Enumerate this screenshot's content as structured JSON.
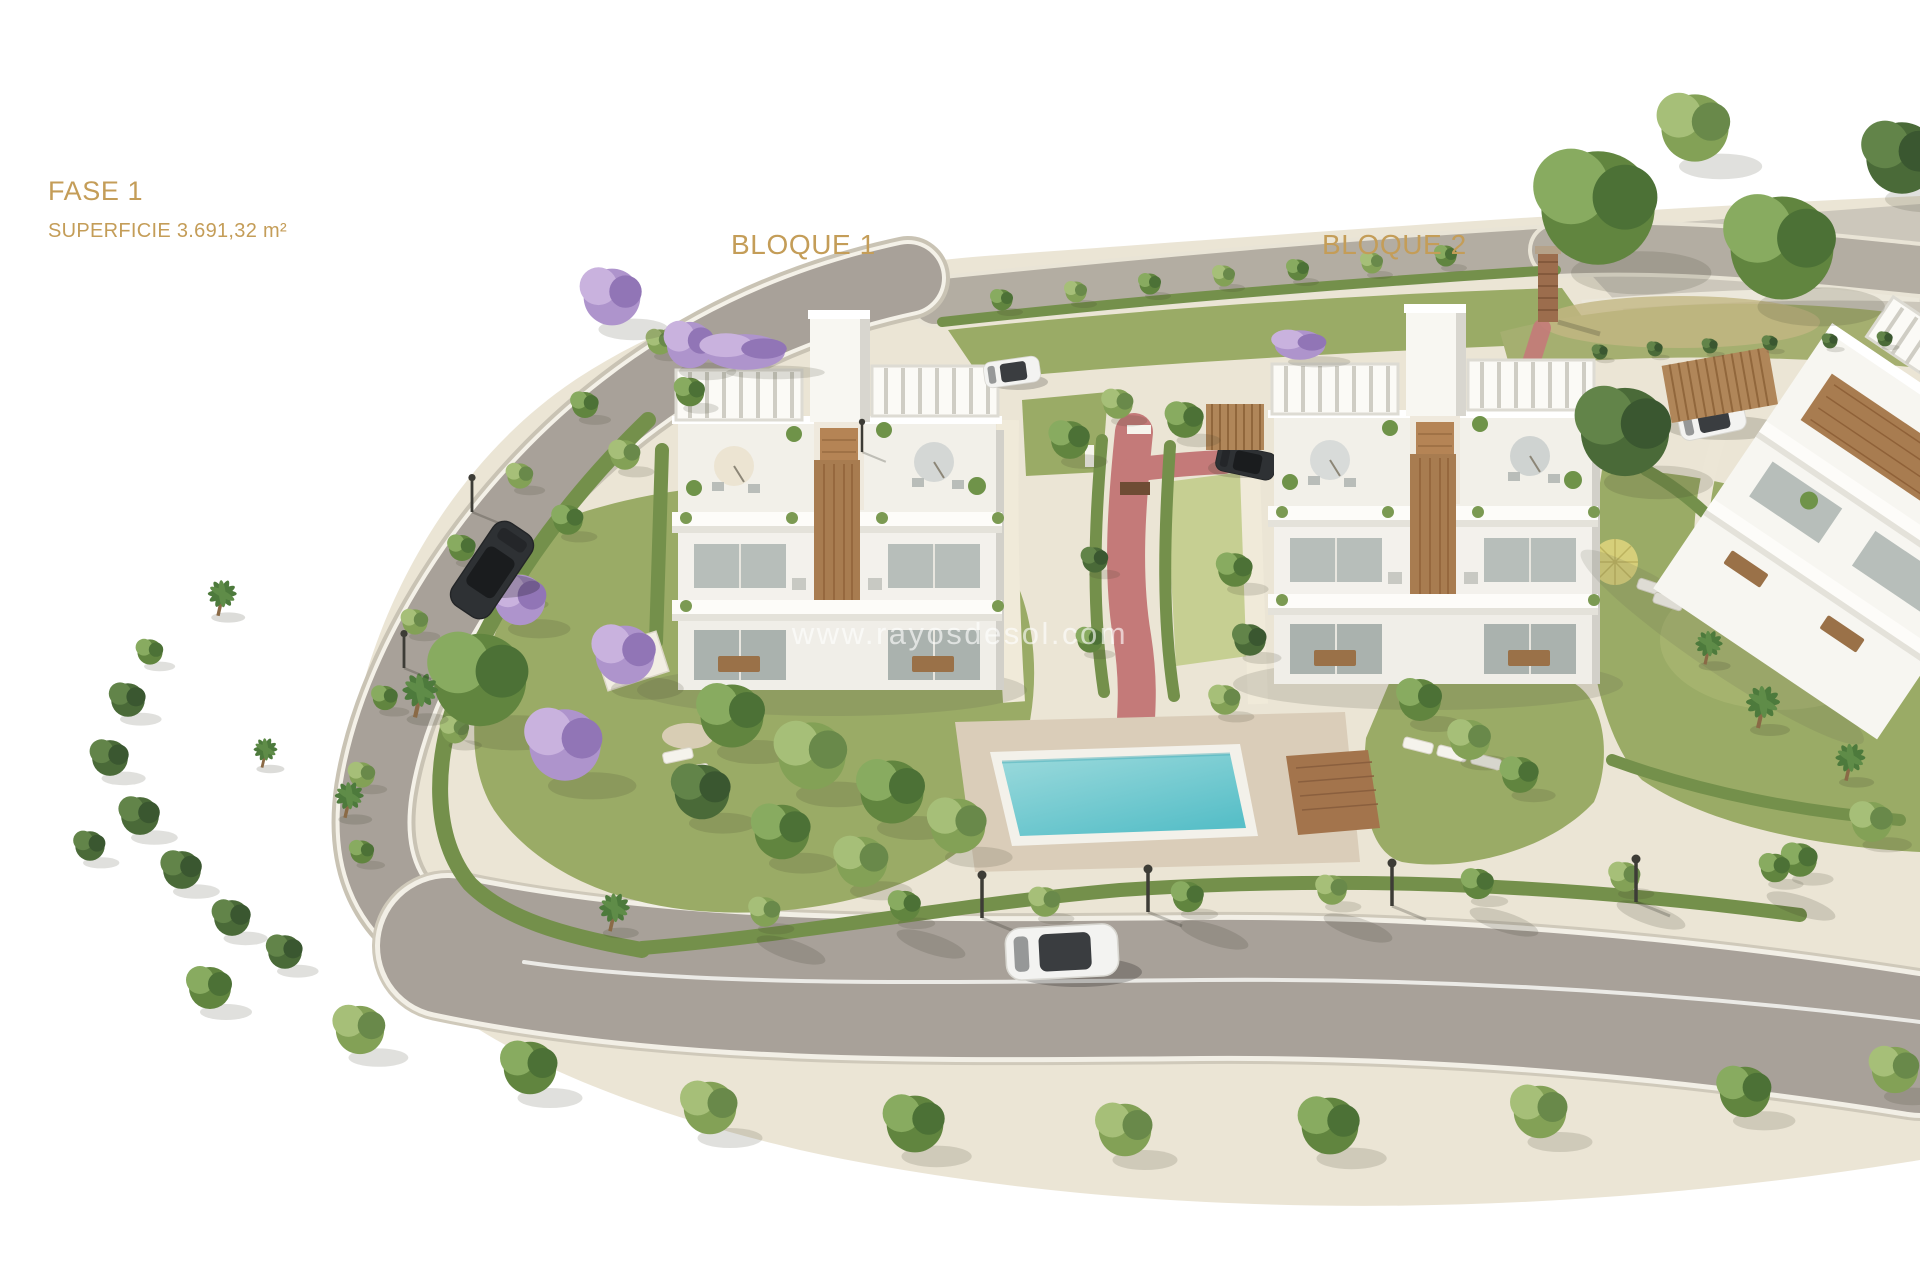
{
  "page": {
    "background": "#ffffff",
    "watermark": "www.rayosdesol.com"
  },
  "annotations": {
    "phase": "FASE 1",
    "surface": "SUPERFICIE 3.691,32 m²",
    "block1": "BLOQUE 1",
    "block2": "BLOQUE 2"
  },
  "colors": {
    "label_gold": "#c49d58",
    "watermark": "rgba(255,255,255,0.62)",
    "road": "#a8a199",
    "road_top": "#b3ada2",
    "sidewalk": "#ebe5d5",
    "plaza": "#ccc7bb",
    "lawn": "#9aab66",
    "lawn_light": "#c6cf92",
    "hedge": "#74904b",
    "pool_water": "#58bfc8",
    "pool_water_light": "#9cdadc",
    "pool_deck": "#dacdb9",
    "wood_deck": "#a3744c",
    "path_red": "#c47a79",
    "building_white": "#f7f6f1",
    "wood_accent": "#a87c50",
    "car_dark": "#2e3134",
    "car_white": "#f3f3f1"
  }
}
